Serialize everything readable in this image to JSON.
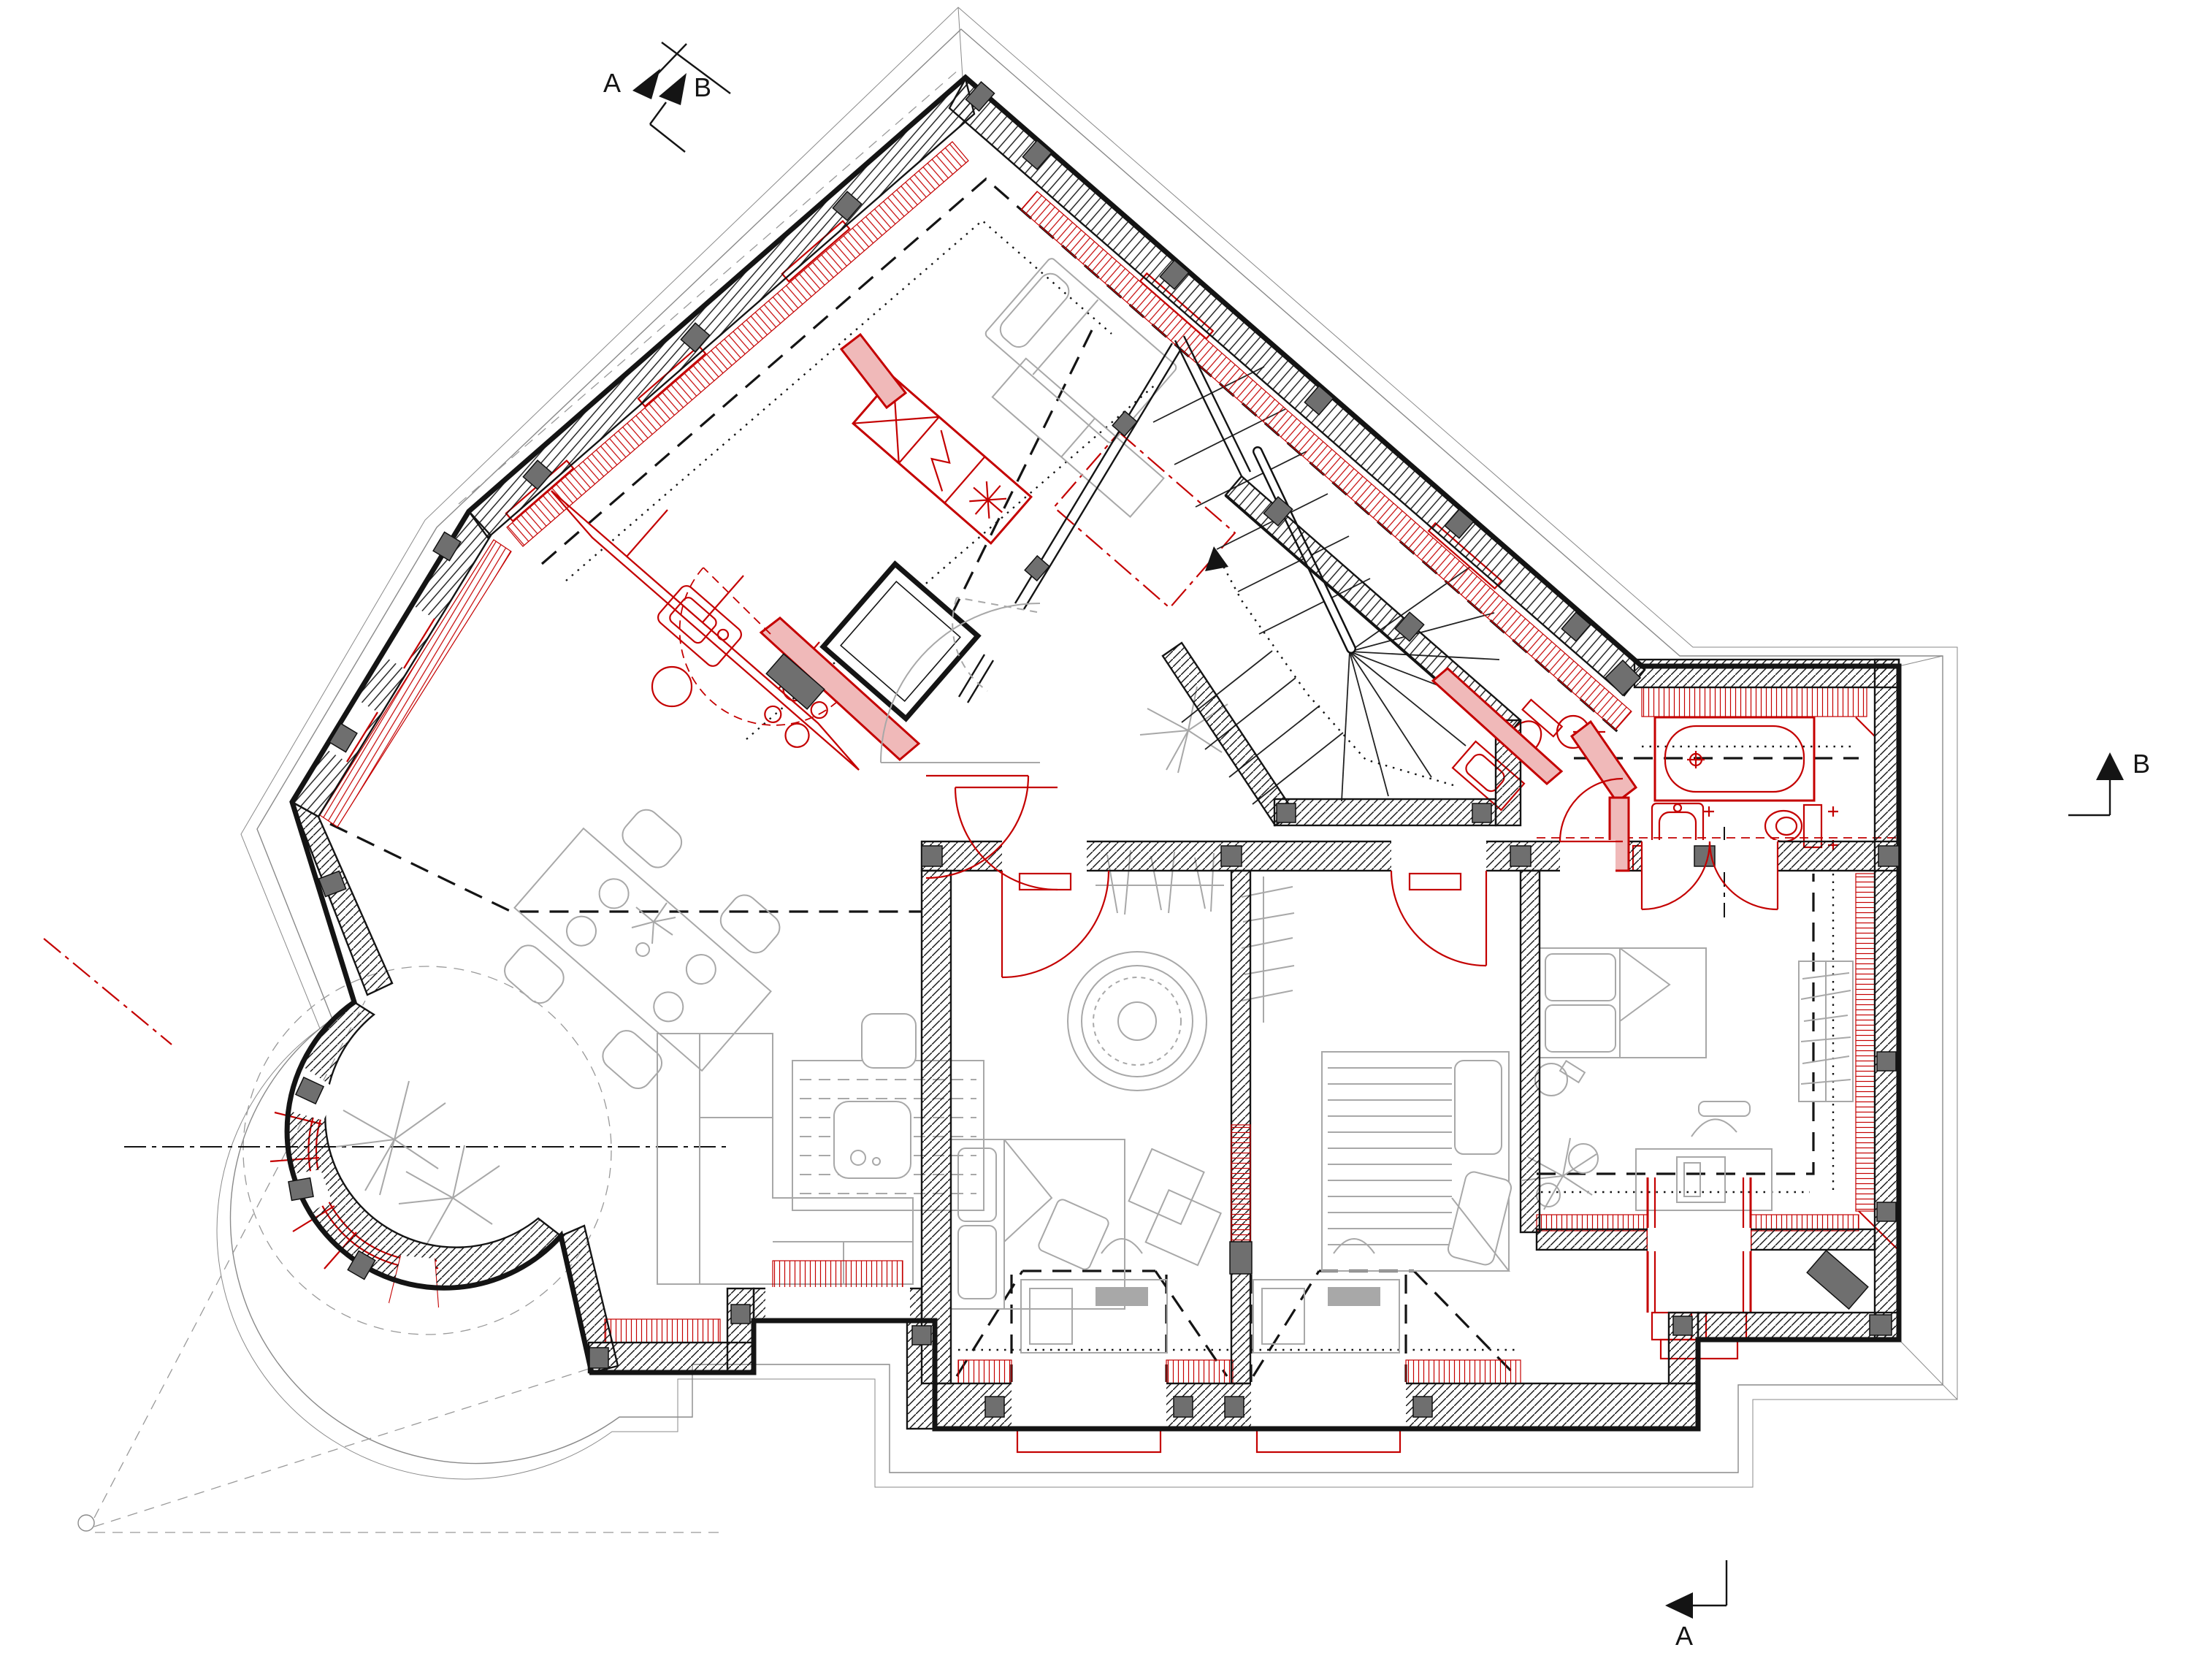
{
  "drawing": {
    "kind": "architectural-floor-plan-attic-level",
    "wall_colors": {
      "existing": "#141414",
      "new": "#c40000",
      "new_fill": "#f0b9b9",
      "furniture": "#a8a8a8",
      "posts": "#6f6f6f",
      "eaves": "#8a8a8a"
    },
    "section_markers": {
      "top": {
        "a_label": "A",
        "b_label": "B"
      },
      "right": {
        "label": "B"
      },
      "bottom": {
        "label": "A"
      }
    },
    "elements": [
      "kitchen-counter",
      "kitchen-sink",
      "stove",
      "fridge-unit",
      "boiler-unit",
      "winder-staircase",
      "bathtub",
      "bathroom-sink",
      "toilet",
      "wc-toilet",
      "wc-sink",
      "dining-table",
      "chairs",
      "corner-sofa",
      "rug",
      "coffee-table",
      "round-rug",
      "bed-attic",
      "bed-room1",
      "bed-room2",
      "bed-room3",
      "desk-room1",
      "desk-room2",
      "desk-room3",
      "wardrobe",
      "plant-turret",
      "plant-palm",
      "plant-monstera",
      "circular-turret",
      "dormer-windows",
      "section-line-markers"
    ]
  }
}
